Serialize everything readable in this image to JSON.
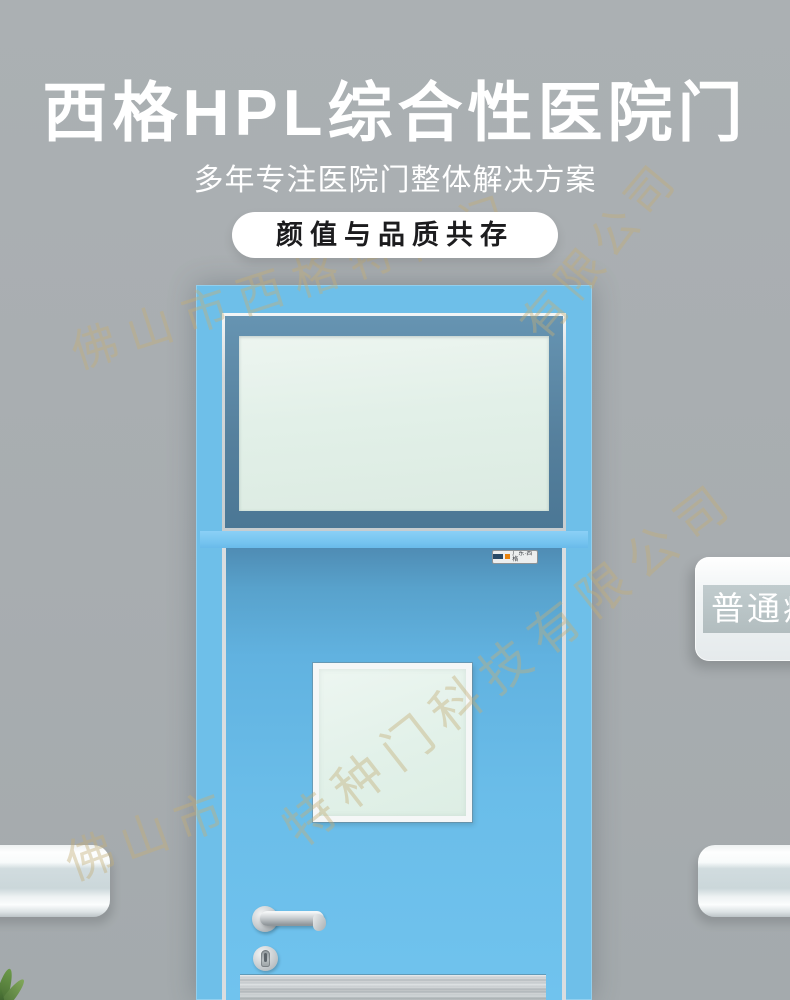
{
  "page": {
    "wall_color": "#a8adb0",
    "accent_blue": "#6ebfe9",
    "glass_green": "#e2f0e8"
  },
  "header": {
    "title": "西格HPL综合性医院门",
    "subtitle": "多年专注医院门整体解决方案",
    "badge": "颜值与品质共存",
    "text_color": "#ffffff",
    "badge_bg": "#ffffff",
    "badge_text_color": "#1c1c1e"
  },
  "watermark": {
    "text": "佛山市西格特种门科技有限公司",
    "color": "#c4ad76",
    "fragments": [
      "佛山市西格特种门",
      "有限公司",
      "佛山市",
      "特种门科技有限公司"
    ]
  },
  "door": {
    "frame_color": "#6ebfe9",
    "leaf_color": "#6abde9",
    "divider_color": "#74c3ef",
    "transom_bevel_color": "#557f9c",
    "transom_glass_color": "#e0efe6",
    "vision_glass_color": "#e2f1e9",
    "trim_color": "#d9dde0",
    "brand_plate": {
      "text": "广东·西格",
      "accent_color": "#e8820c"
    },
    "hardware": {
      "handle": "stainless-lever-handle",
      "lock": "euro-cylinder-lock",
      "finish_color": "#c5cacd"
    },
    "kick_plate_color": "#c0c5c8"
  },
  "room_sign": {
    "text": "普通病房",
    "plate_color": "#f2f5f6",
    "band_color": "#b7c2c4",
    "text_color": "#ffffff"
  },
  "wall_guards": {
    "left": "handrail",
    "right": "handrail",
    "color": "#e9eef0",
    "band_color": "#cdd8db"
  },
  "plant": {
    "color": "#5d8f3f"
  }
}
